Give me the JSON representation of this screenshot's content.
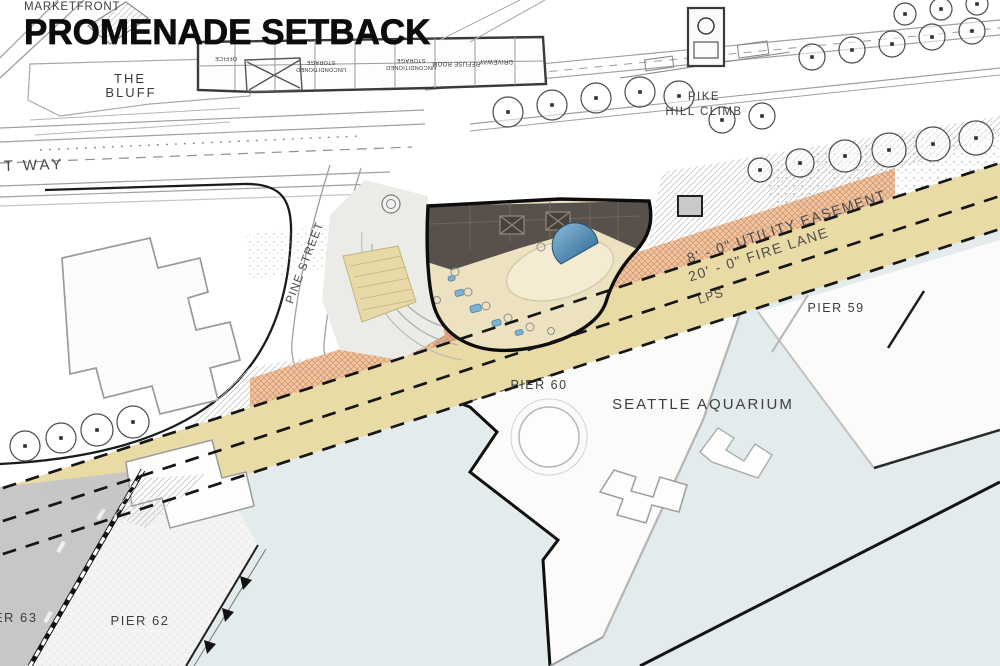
{
  "title": {
    "eyebrow_partial": "PIKE PLACE",
    "eyebrow": "MARKETFRONT",
    "main": "PROMENADE SETBACK"
  },
  "colors": {
    "water": "#e3ebed",
    "fire_lane_band": "#e9dba6",
    "easement_hatch_band": "#efc5a2",
    "building_roof": "#57504b",
    "building_plaza": "#ece2c0",
    "pool": "#3c7ba4",
    "pier_deck_dark": "#c7c7c5",
    "pier_deck_light": "#f4f5f2",
    "title_text": "#0c0c0c"
  },
  "map": {
    "labels": [
      {
        "id": "the-bluff-1",
        "text": "THE",
        "x": 130,
        "y": 83,
        "size": 13,
        "spacing": 2,
        "color": "#3b3b3b"
      },
      {
        "id": "the-bluff-2",
        "text": "BLUFF",
        "x": 131,
        "y": 97,
        "size": 13,
        "spacing": 2,
        "color": "#3b3b3b"
      },
      {
        "id": "t-way",
        "text": "T WAY",
        "x": 4,
        "y": 171,
        "size": 15,
        "spacing": 3,
        "color": "#474747",
        "anchor": "start",
        "rotate": -2
      },
      {
        "id": "pine-street",
        "text": "PINE STREET",
        "x": 308,
        "y": 264,
        "size": 11.5,
        "spacing": 1,
        "color": "#4a4a4a",
        "rotate": -69
      },
      {
        "id": "office",
        "text": "OFFICE",
        "x": 226,
        "y": 57,
        "size": 5.5,
        "spacing": 0.4,
        "color": "#333333",
        "rotate": 180
      },
      {
        "id": "storage-1a",
        "text": "STORAGE",
        "x": 321,
        "y": 61,
        "size": 5.5,
        "spacing": 0.3,
        "color": "#333333",
        "rotate": 180
      },
      {
        "id": "storage-1b",
        "text": "UNCONDITIONED",
        "x": 321,
        "y": 68,
        "size": 5.5,
        "spacing": 0.3,
        "color": "#333333",
        "rotate": 180
      },
      {
        "id": "storage-2a",
        "text": "STORAGE",
        "x": 411,
        "y": 59,
        "size": 5.5,
        "spacing": 0.3,
        "color": "#333333",
        "rotate": 180
      },
      {
        "id": "storage-2b",
        "text": "UNCONDITIONED",
        "x": 411,
        "y": 66,
        "size": 5.5,
        "spacing": 0.3,
        "color": "#333333",
        "rotate": 180
      },
      {
        "id": "refuse-room",
        "text": "REFUSE ROOM",
        "x": 456,
        "y": 62,
        "size": 6,
        "spacing": 0.3,
        "color": "#333333",
        "rotate": 180
      },
      {
        "id": "driveway",
        "text": "DRIVEWAY",
        "x": 496,
        "y": 60,
        "size": 6,
        "spacing": 0.3,
        "color": "#333333",
        "rotate": 180
      },
      {
        "id": "pike",
        "text": "PIKE",
        "x": 704,
        "y": 100,
        "size": 11.5,
        "spacing": 1.5,
        "color": "#3f3f3f"
      },
      {
        "id": "hill-climb",
        "text": "HILL CLIMB",
        "x": 704,
        "y": 115,
        "size": 11.5,
        "spacing": 1.5,
        "color": "#3f3f3f"
      },
      {
        "id": "utility-easement",
        "text": "8' - 0\"  UTILITY EASEMENT",
        "x": 788,
        "y": 231,
        "size": 14,
        "spacing": 1.5,
        "color": "#4c4c4c",
        "rotate": -18
      },
      {
        "id": "fire-lane",
        "text": "20' - 0\"  FIRE LANE",
        "x": 760,
        "y": 259,
        "size": 14,
        "spacing": 1.5,
        "color": "#4c4c4c",
        "rotate": -18
      },
      {
        "id": "lps",
        "text": "LPS",
        "x": 712,
        "y": 300,
        "size": 12.5,
        "spacing": 1,
        "color": "#4c4c4c",
        "rotate": -18
      },
      {
        "id": "pier-59",
        "text": "PIER 59",
        "x": 836,
        "y": 312,
        "size": 12.5,
        "spacing": 1.5,
        "color": "#3e3e3e"
      },
      {
        "id": "pier-60",
        "text": "PIER 60",
        "x": 539,
        "y": 389,
        "size": 12.5,
        "spacing": 1.5,
        "color": "#3e3e3e"
      },
      {
        "id": "seattle-aquarium",
        "text": "SEATTLE AQUARIUM",
        "x": 703,
        "y": 409,
        "size": 15,
        "spacing": 2,
        "color": "#3e3e3e"
      },
      {
        "id": "pier-62",
        "text": "PIER 62",
        "x": 140,
        "y": 625,
        "size": 13,
        "spacing": 1.5,
        "color": "#3e3e3e"
      },
      {
        "id": "pier-63",
        "text": "PIER 63",
        "x": 8,
        "y": 622,
        "size": 13,
        "spacing": 1.5,
        "color": "#3e3e3e"
      }
    ]
  }
}
